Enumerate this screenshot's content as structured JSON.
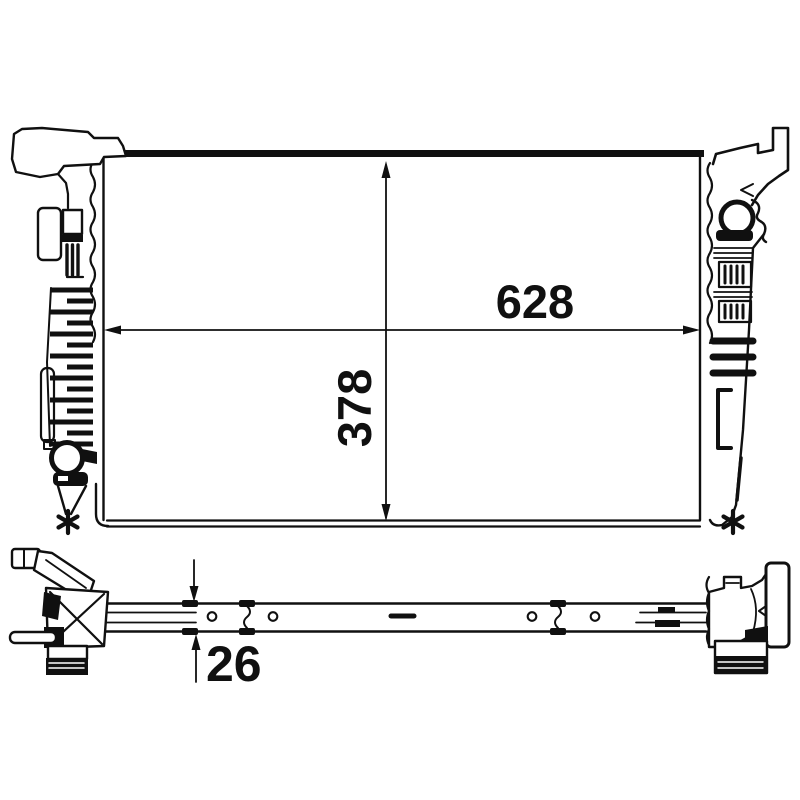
{
  "colors": {
    "line": "#101010",
    "background": "#ffffff"
  },
  "dimension_labels": {
    "width": "628",
    "height": "378",
    "depth": "26"
  },
  "footnote_symbols": {
    "left": "*",
    "right": "*"
  }
}
